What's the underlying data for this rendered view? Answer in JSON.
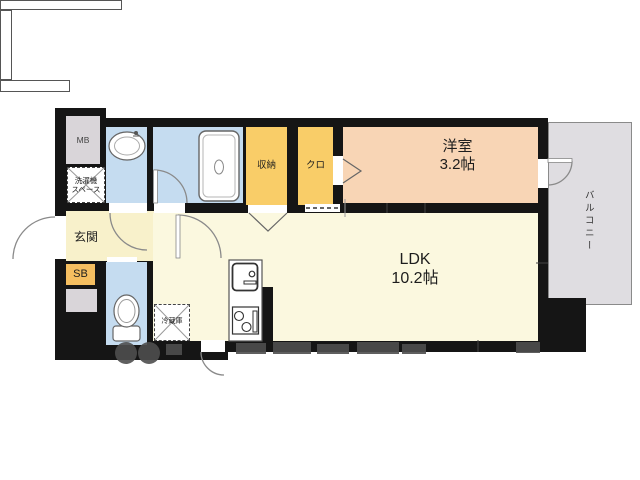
{
  "floor_plan": {
    "labels": {
      "mb": "MB",
      "washer_line1": "洗濯機",
      "washer_line2": "スペース",
      "entrance": "玄関",
      "sb": "SB",
      "storage": "収納",
      "closet": "クロ",
      "western_room_name": "洋室",
      "western_room_size": "3.2帖",
      "ldk_name": "LDK",
      "ldk_size": "10.2帖",
      "fridge": "冷蔵庫",
      "balcony": "バルコニー"
    },
    "colors": {
      "wall": "#151515",
      "blue": "#C5DCF0",
      "yellow": "#F9CD68",
      "orange": "#F5BE60",
      "peach": "#F8D5B5",
      "cream_hall": "#F8F1CB",
      "cream_ldk": "#FBF8DF",
      "greybox": "#D9D5D9",
      "balcony": "#DFDDE1",
      "watermark": "#4E4E4E"
    }
  }
}
